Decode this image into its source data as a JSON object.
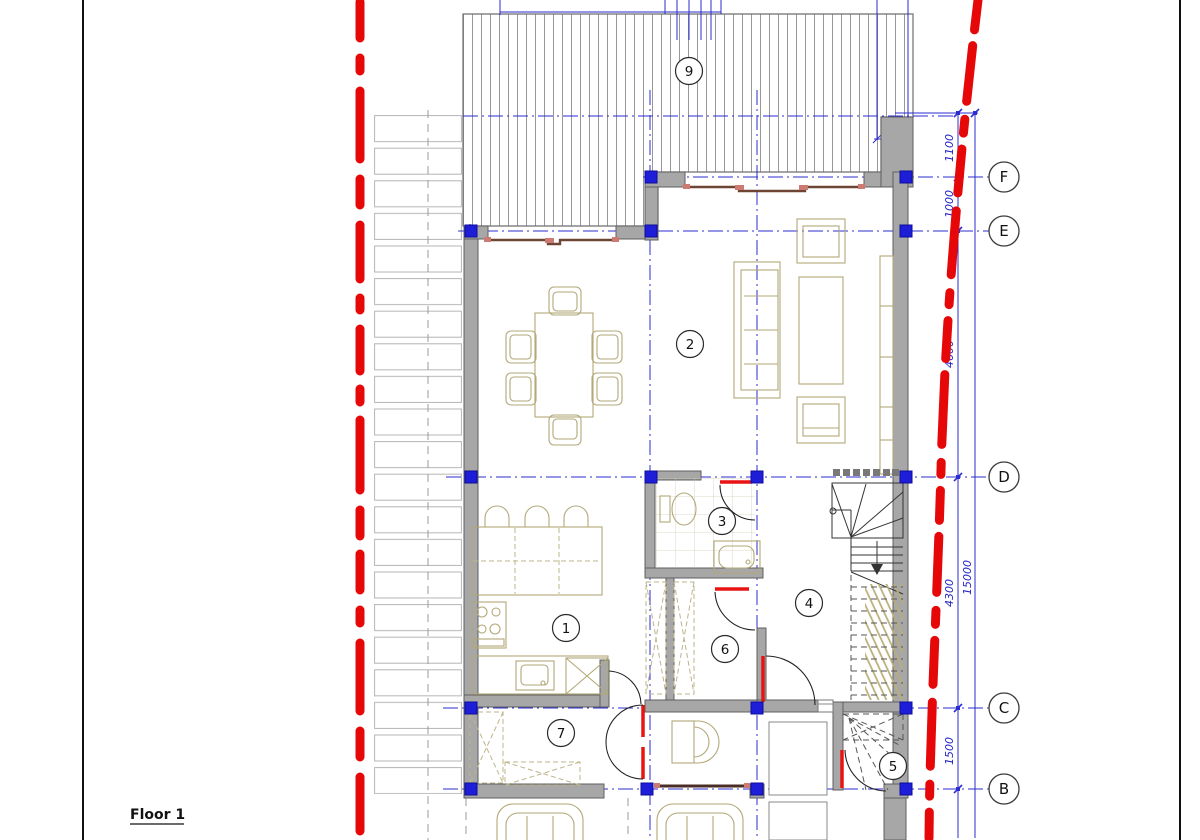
{
  "drawing_title": "Floor 1",
  "grid_bubbles": [
    {
      "label": "F"
    },
    {
      "label": "E"
    },
    {
      "label": "D"
    },
    {
      "label": "C"
    },
    {
      "label": "B"
    }
  ],
  "dimensions": {
    "top_width": {
      "value": "600"
    },
    "vertical_chain": [
      {
        "value": "1100"
      },
      {
        "value": "1000"
      },
      {
        "value": "4600"
      },
      {
        "value": "4300"
      },
      {
        "value": "1500"
      }
    ],
    "overall_height": {
      "value": "15000"
    }
  },
  "room_labels": [
    {
      "number": "1"
    },
    {
      "number": "2"
    },
    {
      "number": "3"
    },
    {
      "number": "4"
    },
    {
      "number": "5"
    },
    {
      "number": "6"
    },
    {
      "number": "7"
    },
    {
      "number": "9"
    }
  ],
  "colors": {
    "boundary_red": "#e60808",
    "grid_blue": "#2c2cd0",
    "wall_gray": "#a7a7a7",
    "furniture_olive": "#b2a878",
    "window_brown": "#6e4434",
    "column_blue": "#1e1ed8",
    "dimension_blue": "#2424c4"
  }
}
